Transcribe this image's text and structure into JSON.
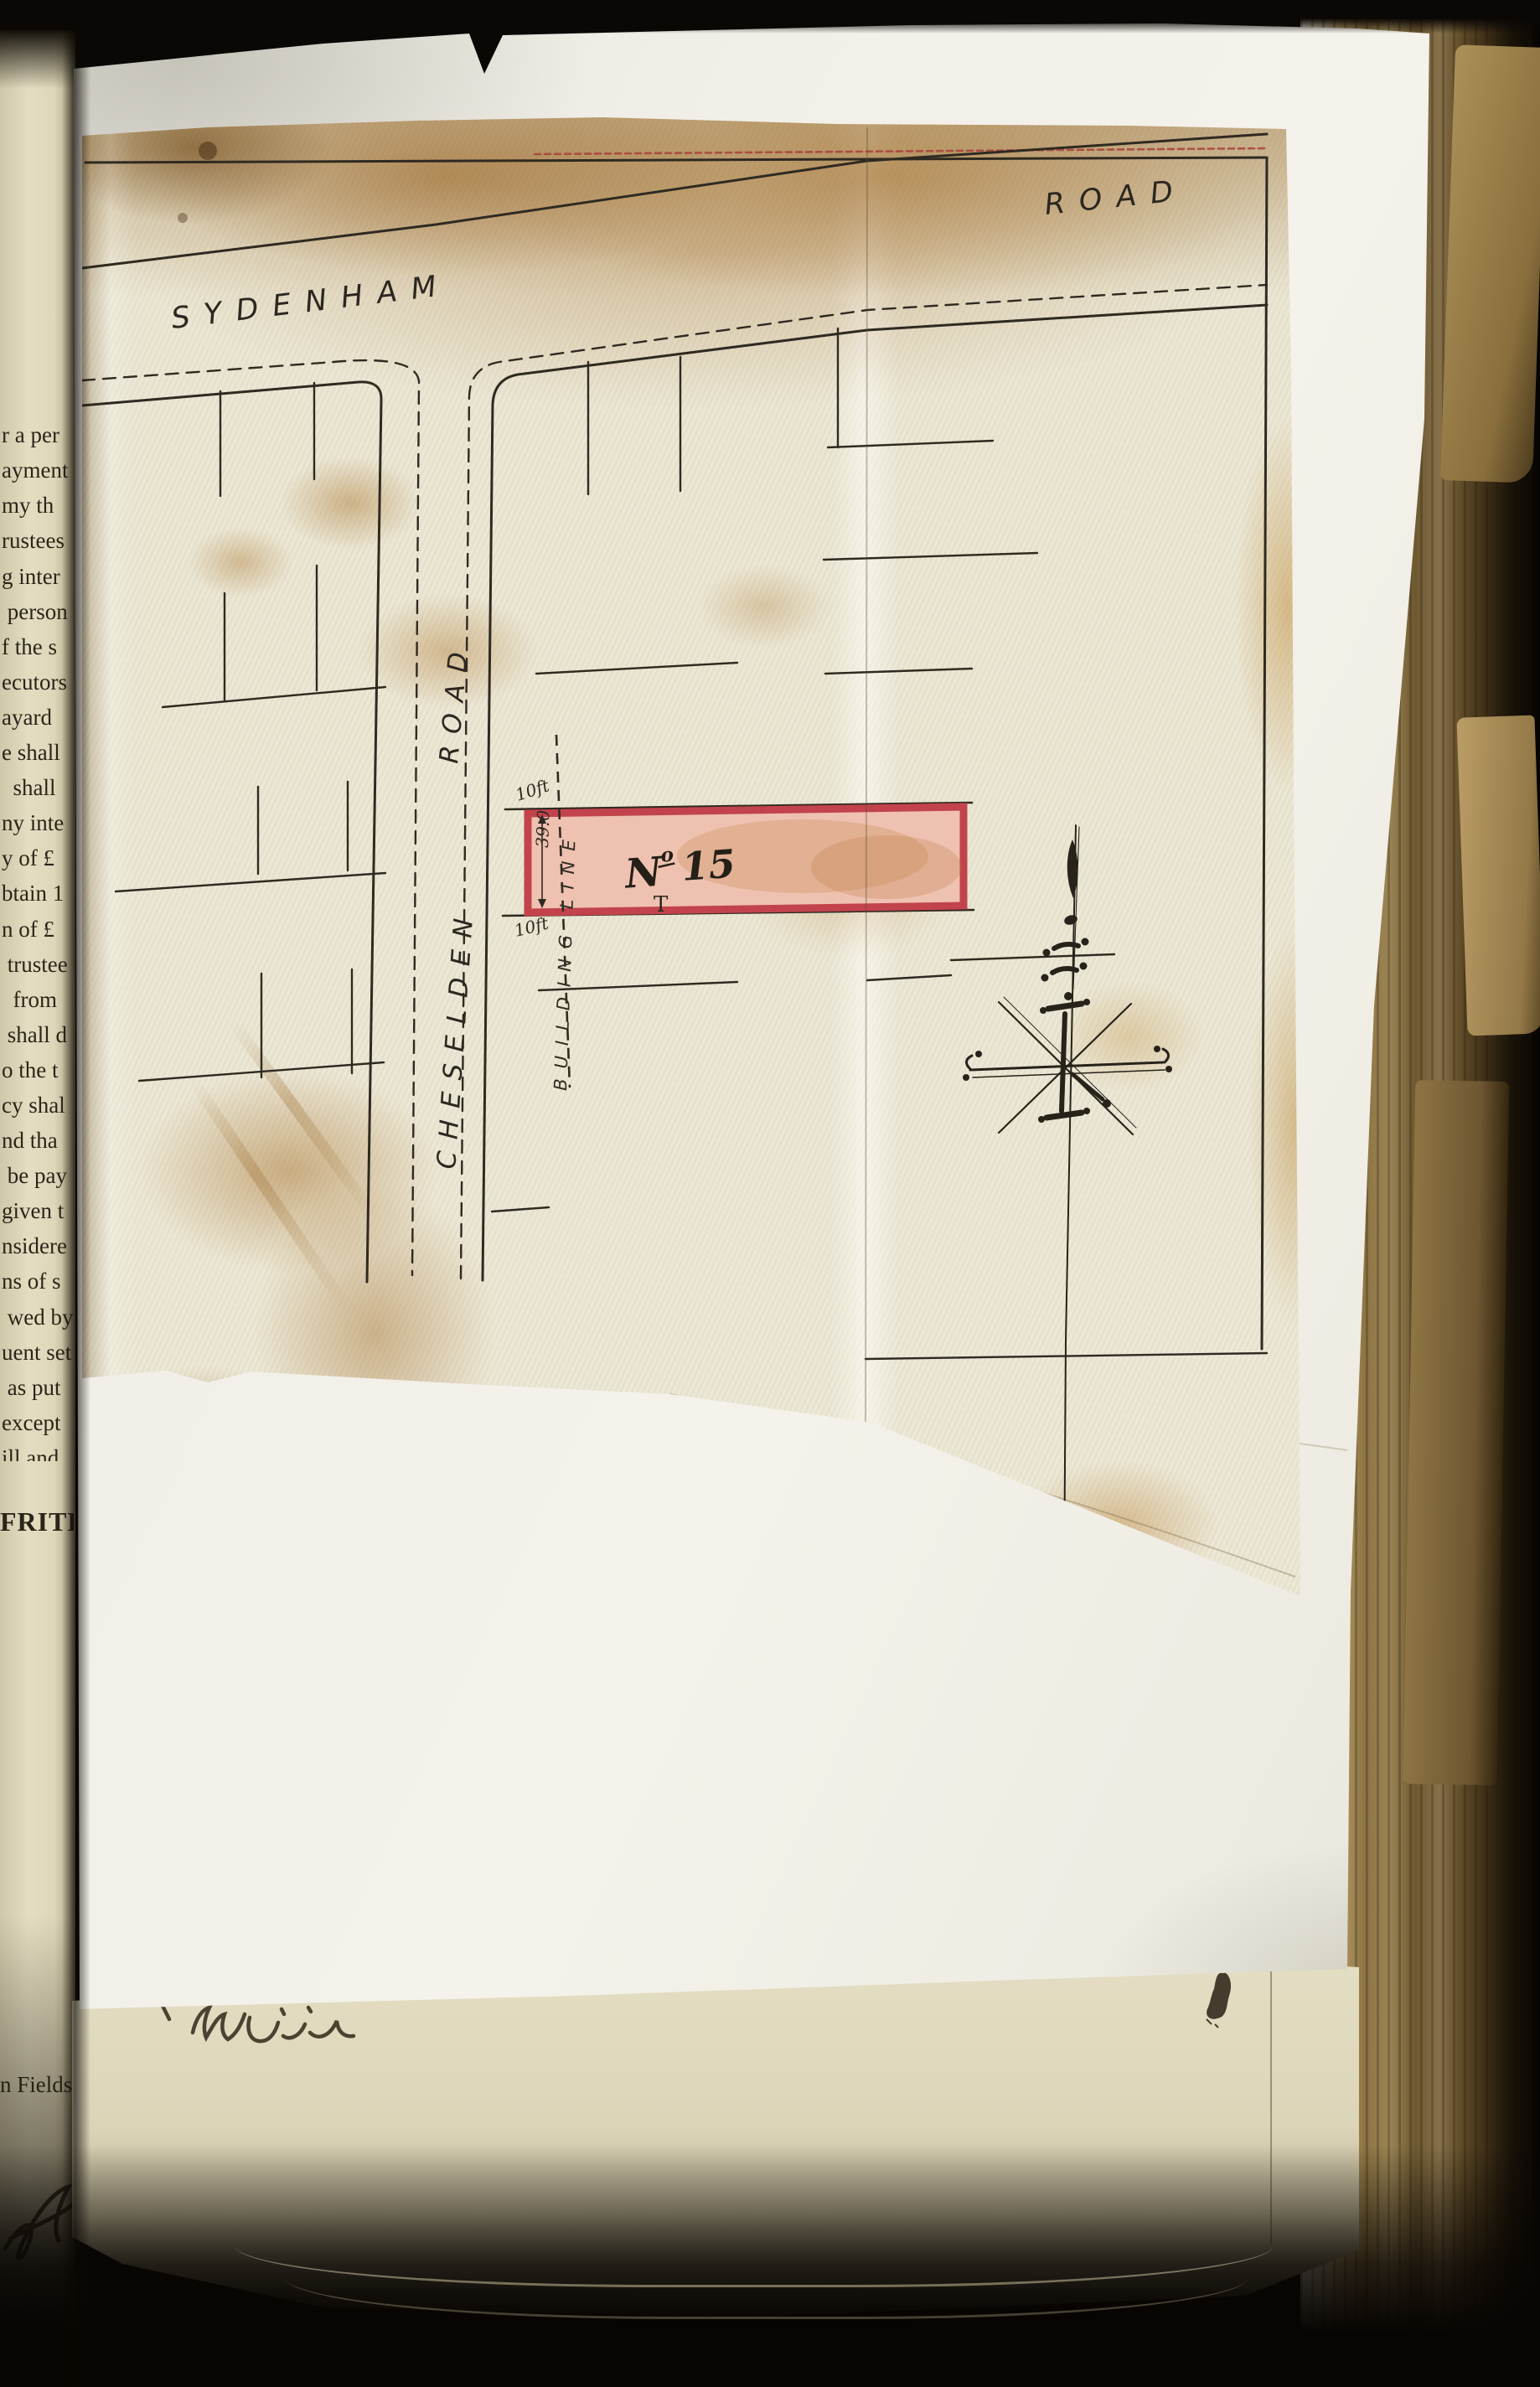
{
  "left_page": {
    "lines": [
      "r a per",
      "ayment",
      "my th",
      "rustees",
      "g inter",
      " person",
      "f the s",
      "ecutors",
      "ayard",
      "e shall",
      "  shall",
      "ny inte",
      "y of £",
      "btain 1",
      "n of £",
      " trustee",
      "  from",
      " shall d",
      "o the t",
      "cy shal",
      "nd tha",
      " be pay",
      "given t",
      "nsidere",
      "ns of s",
      " wed by",
      "uent set",
      " as put",
      "except",
      "ill and",
      " have h"
    ],
    "closing": "FRITH.",
    "fields_line": "n Fields.}"
  },
  "map": {
    "road_sydenham": "SYDENHAM",
    "road_sydenham_suffix": "ROAD",
    "road_cheselden": "CHESELDEN",
    "road_cheselden_suffix": "ROAD",
    "plot": {
      "prefix": "N",
      "sup": "o",
      "number": "15",
      "frontage_top": "10ft",
      "frontage_bottom": "10ft",
      "depth": "39:0",
      "building_line": "BUILDING LINE",
      "tee": "T"
    },
    "colors": {
      "plot_fill": "#eec1b0",
      "plot_border": "#c2434c",
      "ink": "#2f2a21",
      "border_dash_red": "#a8423a"
    }
  },
  "under_page": {
    "handwriting": "Will"
  }
}
